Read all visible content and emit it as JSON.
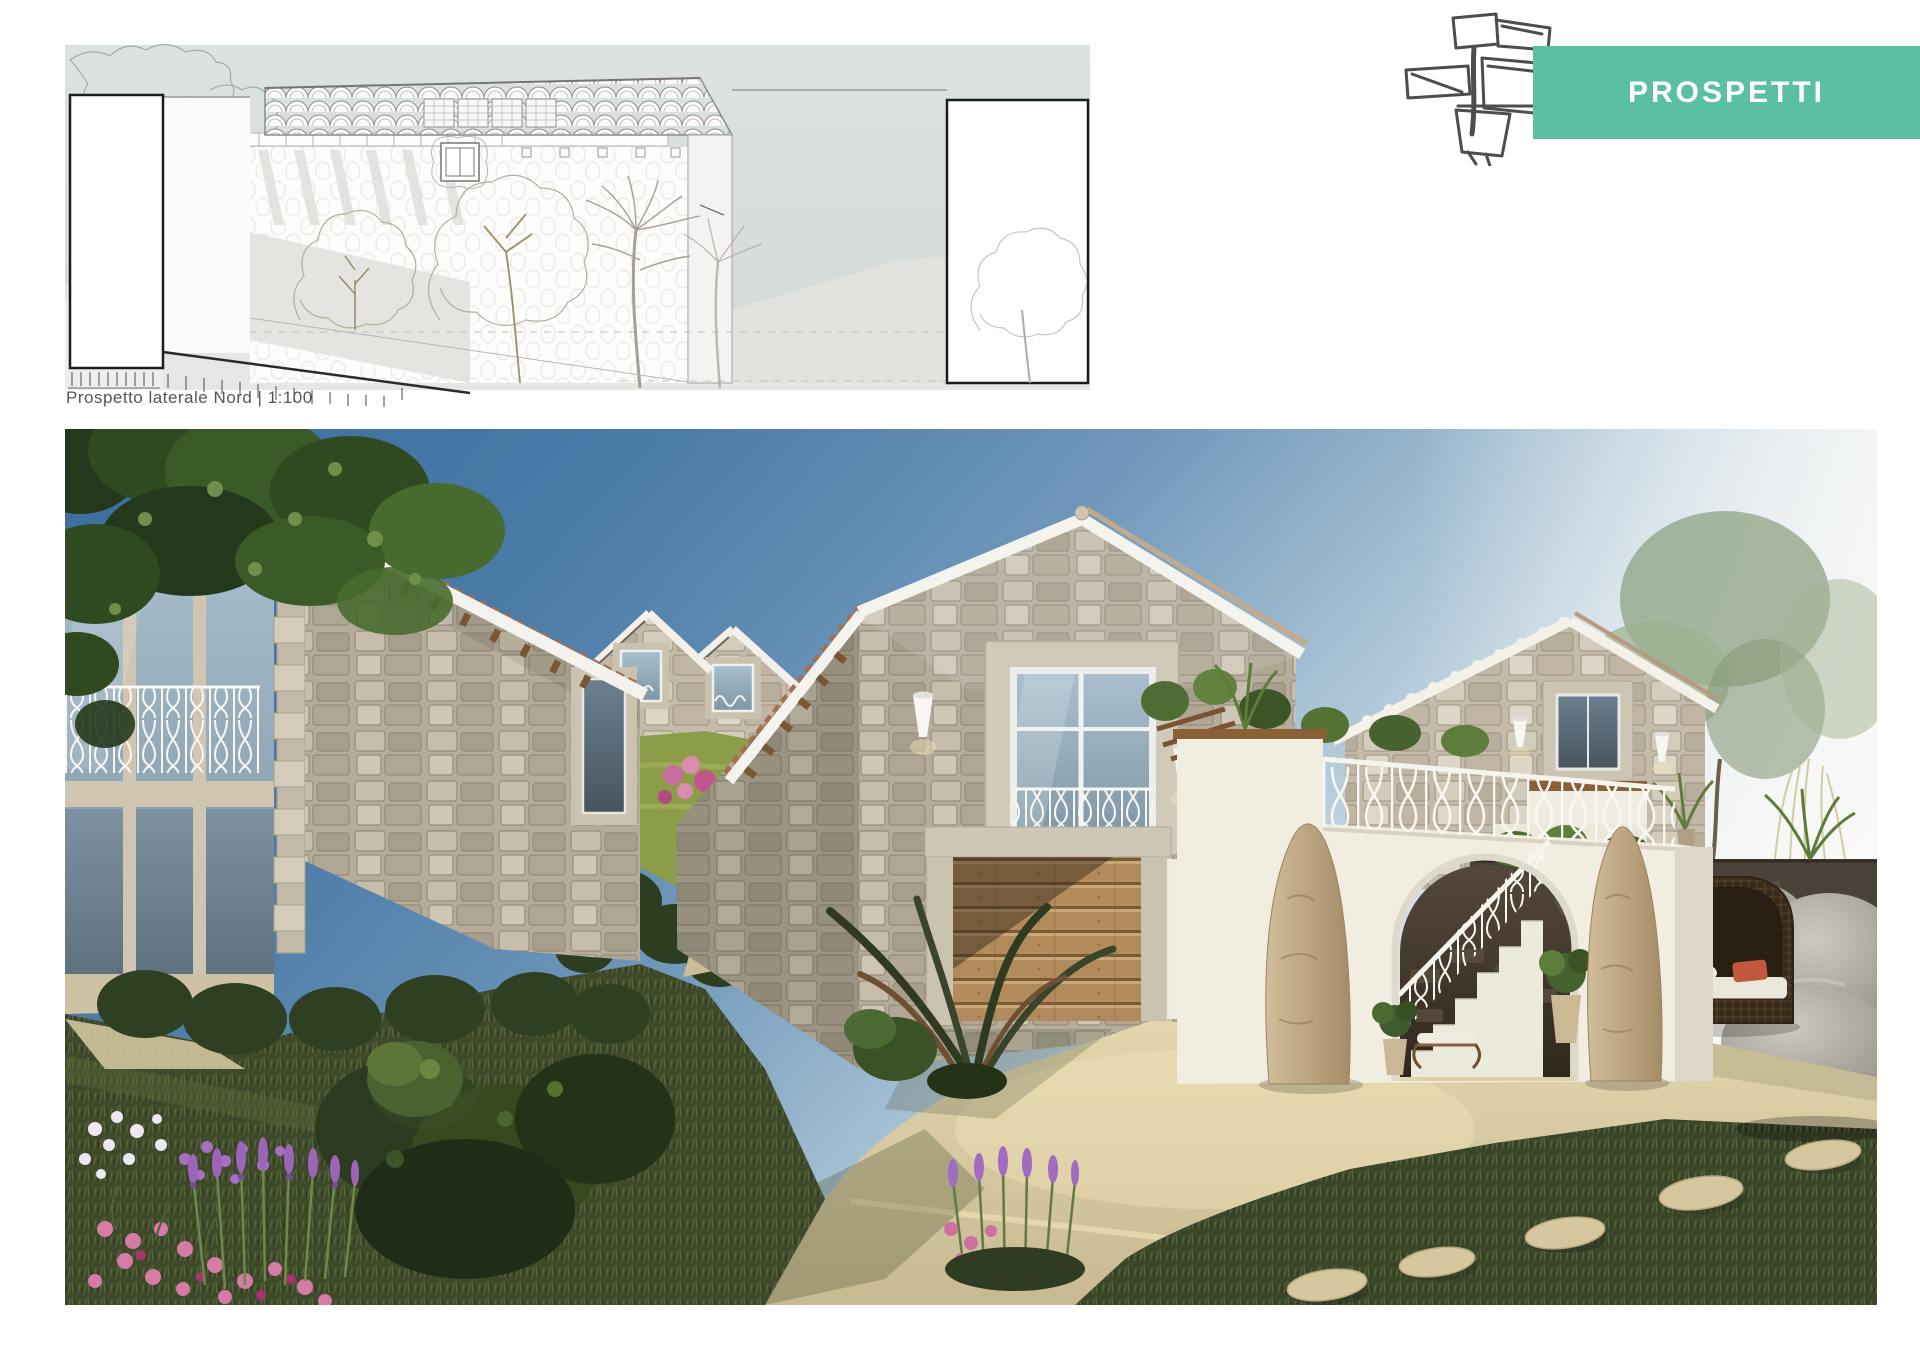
{
  "header": {
    "logo_icon": "architect-sketch-icon",
    "banner": {
      "label": "PROSPETTI",
      "background_color": "#5ABFA3",
      "text_color": "#FFFFFF"
    }
  },
  "elevation": {
    "caption": "Prospetto laterale Nord | 1:100",
    "view_name": "Prospetto laterale Nord",
    "scale": "1:100",
    "background_color": "#D8DFDB"
  },
  "render": {
    "subject": "stone-villas-garden-rendering",
    "colors": {
      "sky": "#4678A6",
      "stone": "#B7AE9C",
      "white_plaster": "#EFEBE0",
      "wood_door": "#B28B5D",
      "grass": "#3F4A2B",
      "lawn": "#8C9D4A",
      "patio": "#D9CCA5",
      "lavender": "#9D64B8",
      "pink_flowers": "#D67BA6"
    }
  }
}
